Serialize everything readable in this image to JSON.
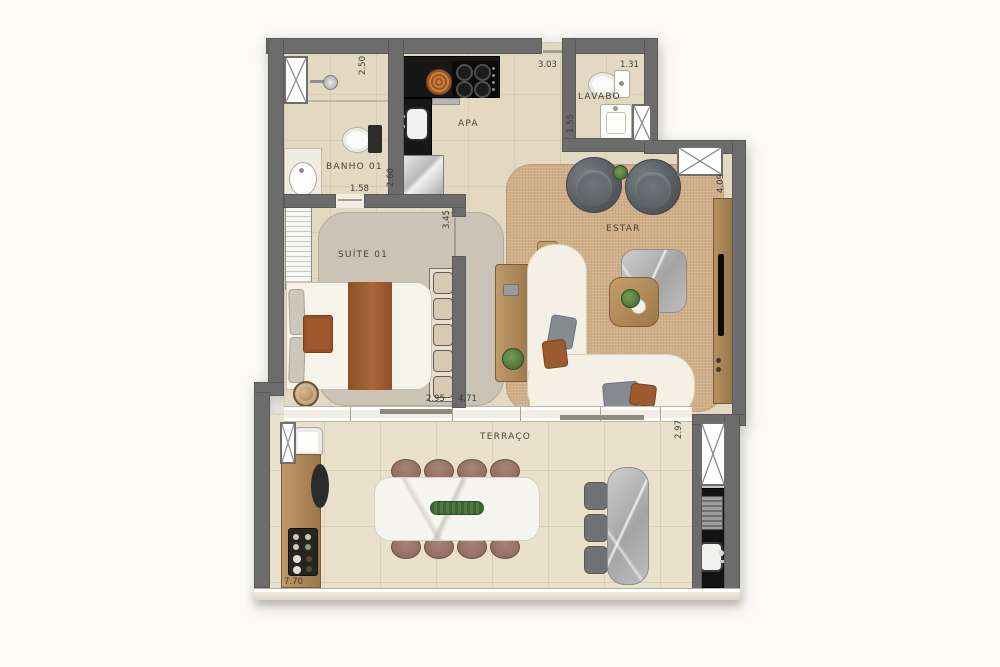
{
  "rooms": {
    "banho": "BANHO 01",
    "kitchen": "APA",
    "lavabo": "LAVABO",
    "suite": "SUÍTE 01",
    "estar": "ESTAR",
    "terraco": "TERRAÇO"
  },
  "dimensions": {
    "banho_depth": "2.50",
    "banho_door": "1.58",
    "kitchen_top": "3.03",
    "kitchen_depth": "2.60",
    "lavabo_width": "1.31",
    "lavabo_depth": "1.55",
    "hall_depth": "3.45",
    "estar_depth": "4.09",
    "suite_width": "2.95",
    "estar_width": "4.71",
    "terraco_depth": "2.97",
    "terraco_width": "7.70"
  },
  "colors": {
    "wall": "#6c6c6c",
    "floor": "#e3d9c3",
    "terrace_floor": "#eae1cc",
    "estar_rug": "#d1ae87",
    "suite_rug": "#cbc3b6",
    "kitchen_counter": "#171717",
    "wood": "#b18c5e",
    "sofa": "#f4f0e5",
    "accent_throw": "#9c5a30",
    "marble": "#b9b9b9",
    "label_text": "#4a423a"
  }
}
